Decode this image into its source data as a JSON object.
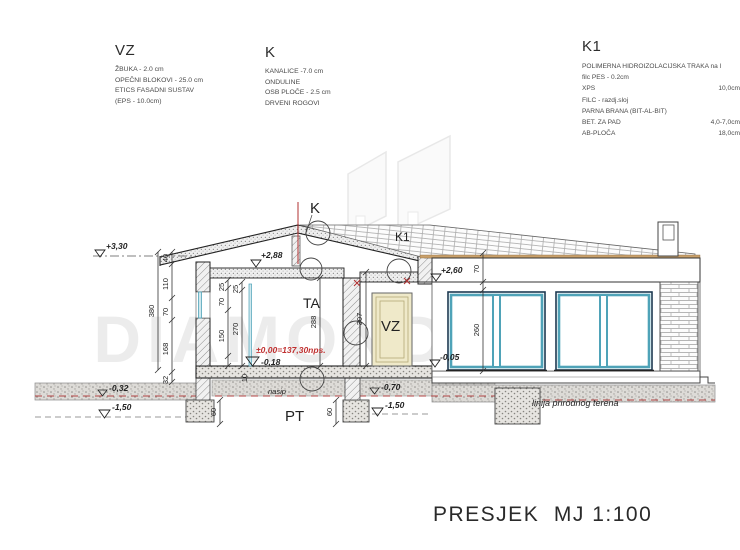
{
  "legend": {
    "vz": {
      "title": "VZ",
      "lines": [
        "ŽBUKA - 2.0 cm",
        "OPEČNI BLOKOVI - 25.0 cm",
        "ETICS FASADNI SUSTAV",
        "(EPS - 10.0cm)"
      ]
    },
    "k": {
      "title": "K",
      "lines": [
        "KANALICE -7.0 cm",
        "ONDULINE",
        "OSB PLOČE - 2.5 cm",
        "DRVENI ROGOVI"
      ]
    },
    "k1": {
      "title": "K1",
      "rows": [
        {
          "label": "POLIMERNA HIDROIZOLACIJSKA TRAKA na l",
          "value": ""
        },
        {
          "label": "filc PES - 0.2cm",
          "value": ""
        },
        {
          "label": "XPS",
          "value": "10,0cm"
        },
        {
          "label": "FILC - razdj.sloj",
          "value": ""
        },
        {
          "label": "PARNA BRANA (BIT-AL-BIT)",
          "value": ""
        },
        {
          "label": "BET. ZA PAD",
          "value": "4,0-7,0cm"
        },
        {
          "label": "AB-PLOČA",
          "value": "18,0cm"
        }
      ]
    }
  },
  "drawing": {
    "labels": {
      "k": "K",
      "k1": "K1",
      "ta": "TA",
      "vz_door": "VZ",
      "pt": "PT"
    },
    "levels": {
      "ridge": "+3,30",
      "ceiling_left": "+2,88",
      "ceiling_right": "+2,60",
      "floor_zero": "±0,00=137,30nps.",
      "minus_018": "-0,18",
      "minus_005": "-0,05",
      "minus_032": "-0,32",
      "minus_070": "-0,70",
      "minus_150_left": "-1,50",
      "minus_150_mid": "-1,50"
    },
    "dims": {
      "total_left": "380",
      "seg_40": "40",
      "seg_110": "110",
      "seg_70": "70",
      "seg_168": "168",
      "seg_32": "32",
      "in_25a": "25",
      "in_70": "70",
      "in_150": "150",
      "in_25b": "25",
      "in_270": "270",
      "room_288": "288",
      "door_307": "307",
      "right_70": "70",
      "right_260": "260",
      "foot_60a": "60",
      "foot_60b": "60",
      "slab_10": "10"
    },
    "notes": {
      "nasip": "nasip",
      "terrain": "linija prirodnog terena"
    }
  },
  "watermark": {
    "text": "DIAMOND"
  },
  "title": "PRESJEK  MJ 1:100",
  "colors": {
    "window_frame_teal": "#4fa3b8",
    "window_frame_dark": "#1d3a52",
    "door_beige": "#efe9c9",
    "level_red": "#c03030",
    "terrain_line_red": "#b04040",
    "roof_edge_tan": "#c9a06a"
  }
}
